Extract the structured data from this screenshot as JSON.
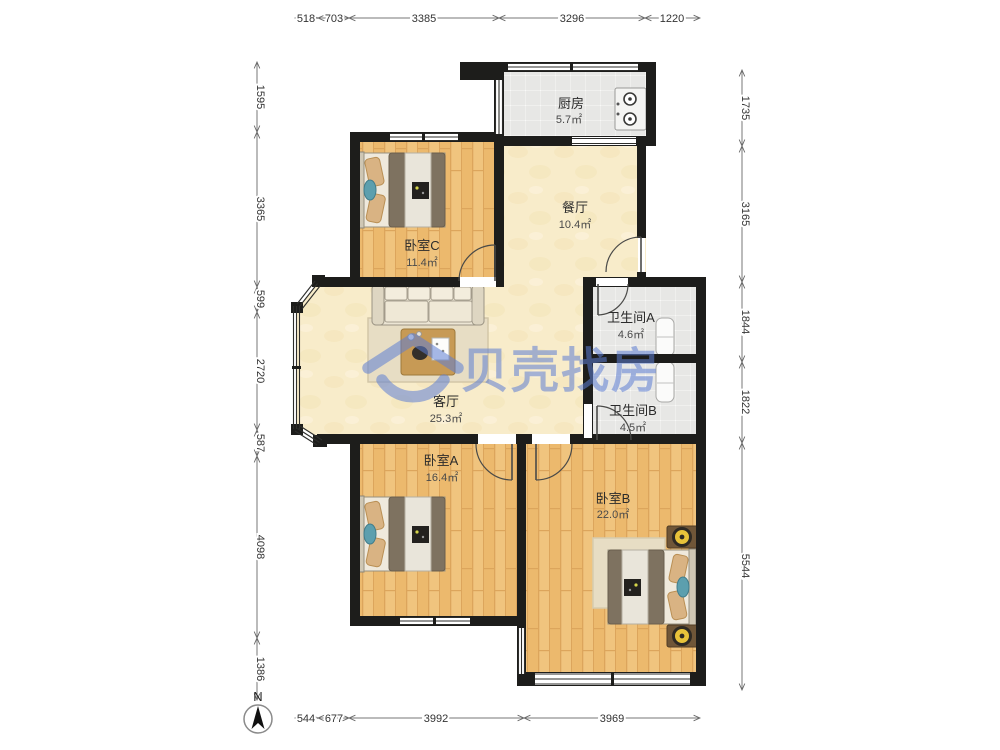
{
  "brand": {
    "watermark_text": "贝壳找房"
  },
  "compass": {
    "north_label": "N"
  },
  "rooms": {
    "kitchen": {
      "name": "厨房",
      "area": "5.7㎡"
    },
    "dining": {
      "name": "餐厅",
      "area": "10.4㎡"
    },
    "bedroom_c": {
      "name": "卧室C",
      "area": "11.4㎡"
    },
    "bathroom_a": {
      "name": "卫生间A",
      "area": "4.6㎡"
    },
    "bathroom_b": {
      "name": "卫生间B",
      "area": "4.5㎡"
    },
    "living": {
      "name": "客厅",
      "area": "25.3㎡"
    },
    "bedroom_a": {
      "name": "卧室A",
      "area": "16.4㎡"
    },
    "bedroom_b": {
      "name": "卧室B",
      "area": "22.0㎡"
    }
  },
  "dimensions_mm": {
    "top": [
      "518",
      "703",
      "3385",
      "3296",
      "1220"
    ],
    "bottom": [
      "544",
      "677",
      "3992",
      "3969"
    ],
    "left": [
      "1595",
      "3365",
      "599",
      "2720",
      "587",
      "4098",
      "1386"
    ],
    "right": [
      "1735",
      "3165",
      "1844",
      "1822",
      "5544"
    ]
  },
  "colors": {
    "wall": "#1d1d1b",
    "wood_floor": "#f0c47e",
    "tile_floor": "#e7e7e5",
    "living_floor": "#f8ecca",
    "watermark_blue": "#5c7ed3",
    "dimension_text": "#333333"
  }
}
